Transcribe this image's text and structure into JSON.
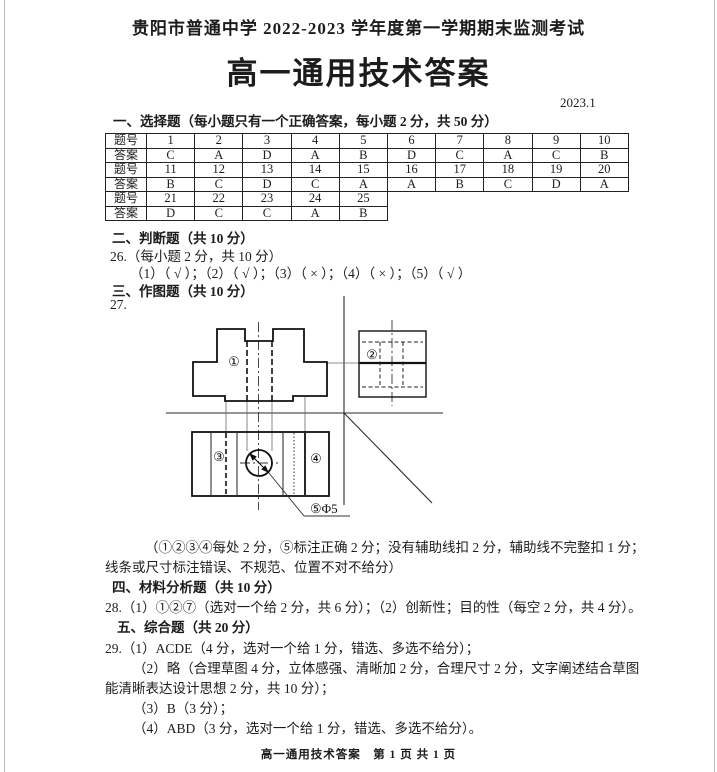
{
  "page": {
    "school_header": "贵阳市普通中学 2022-2023 学年度第一学期期末监测考试",
    "title": "高一通用技术答案",
    "date": "2023.1",
    "footer": "高一通用技术答案　第 1 页 共 1 页"
  },
  "sections": {
    "s1_header": "一、选择题（每小题只有一个正确答案，每小题 2 分，共 50 分）",
    "s2_header": "二、判断题（共 10 分）",
    "q26_intro": "26.（每小题 2 分，共 10 分）",
    "q26_answers": "（1）（ √ ）；（2）（ √ ）；（3）（ × ）；（4）（ × ）；（5）（ √ ）",
    "s3_header": "三、作图题（共 10 分）",
    "q27_label": "27.",
    "q27_scoring_line1": "（①②③④每处 2 分，⑤标注正确 2 分；没有辅助线扣 2 分，辅助线不完整扣 1 分；",
    "q27_scoring_line2": "线条或尺寸标注错误、不规范、位置不对不给分）",
    "s4_header": "四、材料分析题（共 10 分）",
    "q28_answer": "28.（1）①②⑦（选对一个给 2 分，共 6 分）；（2）创新性；目的性（每空 2 分，共 4 分）。",
    "s5_header": "五、综合题（共 20 分）",
    "q29_1": "29.（1）ACDE（4 分，选对一个给 1 分，错选、多选不给分）；",
    "q29_2a": "（2）略（合理草图 4 分，立体感强、清晰加 2 分，合理尺寸 2 分，文字阐述结合草图",
    "q29_2b": "能清晰表达设计思想 2 分，共 10 分）；",
    "q29_3": "（3）B（3 分）；",
    "q29_4": "（4）ABD（3 分，选对一个给 1 分，错选、多选不给分）。"
  },
  "choice_table": {
    "rows": [
      {
        "type": "q",
        "label": "题号",
        "cells": [
          "1",
          "2",
          "3",
          "4",
          "5",
          "6",
          "7",
          "8",
          "9",
          "10"
        ]
      },
      {
        "type": "a",
        "label": "答案",
        "cells": [
          "C",
          "A",
          "D",
          "A",
          "B",
          "D",
          "C",
          "A",
          "C",
          "B"
        ]
      },
      {
        "type": "q",
        "label": "题号",
        "cells": [
          "11",
          "12",
          "13",
          "14",
          "15",
          "16",
          "17",
          "18",
          "19",
          "20"
        ]
      },
      {
        "type": "a",
        "label": "答案",
        "cells": [
          "B",
          "C",
          "D",
          "C",
          "A",
          "A",
          "B",
          "C",
          "D",
          "A"
        ]
      },
      {
        "type": "q",
        "label": "题号",
        "cells": [
          "21",
          "22",
          "23",
          "24",
          "25"
        ]
      },
      {
        "type": "a",
        "label": "答案",
        "cells": [
          "D",
          "C",
          "C",
          "A",
          "B"
        ]
      }
    ]
  },
  "diagram": {
    "label_view1": "①",
    "label_view2": "②",
    "label_view3": "③",
    "label_view4": "④",
    "label_dimension": "⑤Φ5"
  }
}
